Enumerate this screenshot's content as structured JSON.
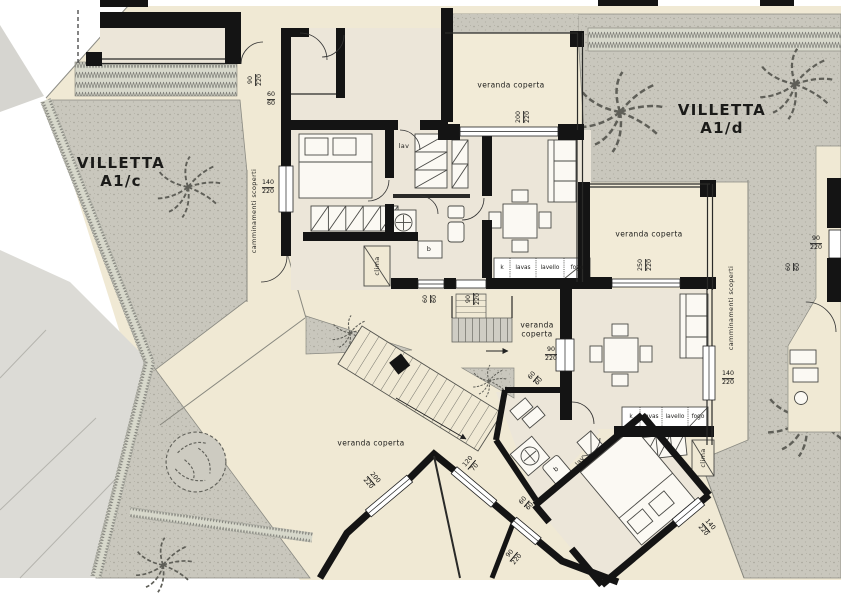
{
  "villas": {
    "left": {
      "name": "VILLETTA",
      "unit": "A1/c"
    },
    "right": {
      "name": "VILLETTA",
      "unit": "A1/d"
    }
  },
  "labels": {
    "veranda_top": "veranda coperta",
    "veranda_right": "veranda coperta",
    "veranda_mid_l1": "veranda",
    "veranda_mid_l2": "coperta",
    "veranda_bottom": "veranda coperta",
    "walkway_left": "camminamenti scoperti",
    "walkway_right": "camminamenti scoperti",
    "laundry_left": "lav",
    "laundry_right": "lav",
    "clima_left": "clima",
    "clima_right": "clima",
    "boiler_left": "b",
    "boiler_right": "b"
  },
  "kitchens": {
    "left": [
      "k",
      "lavas",
      "lavello",
      "fogo"
    ],
    "right": [
      "k",
      "lavas",
      "lavello",
      "fogo"
    ]
  },
  "dims": {
    "d1": {
      "a": "90",
      "b": "220"
    },
    "d2": {
      "a": "60",
      "b": "60"
    },
    "d3": {
      "a": "140",
      "b": "220"
    },
    "d4": {
      "a": "200",
      "b": "220"
    },
    "d5": {
      "a": "250",
      "b": "220"
    },
    "d6": {
      "a": "60",
      "b": "60"
    },
    "d7": {
      "a": "90",
      "b": "220"
    },
    "d8": {
      "a": "90",
      "b": "220"
    },
    "d9": {
      "a": "60",
      "b": "60"
    },
    "d10": {
      "a": "90",
      "b": "220"
    },
    "d11": {
      "a": "60",
      "b": "60"
    },
    "d12": {
      "a": "140",
      "b": "220"
    },
    "d13": {
      "a": "200",
      "b": "220"
    },
    "d14": {
      "a": "120",
      "b": "70"
    },
    "d15": {
      "a": "60",
      "b": "60"
    },
    "d16": {
      "a": "90",
      "b": "220"
    },
    "d17": {
      "a": "140",
      "b": "220"
    }
  },
  "colors": {
    "wall": "#141414",
    "site": "#f0e9d4",
    "room": "#ece6d9",
    "garden": "#c9c7bd",
    "driveway": "#dcdbd6"
  }
}
